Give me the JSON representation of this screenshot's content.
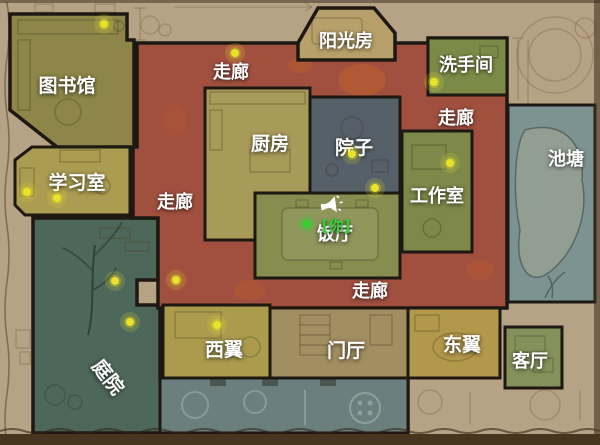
{
  "map": {
    "rooms": [
      {
        "id": "library",
        "label": "图书馆",
        "x": 67,
        "y": 92,
        "size": 19
      },
      {
        "id": "study",
        "label": "学习室",
        "x": 77,
        "y": 189,
        "size": 19
      },
      {
        "id": "sunroom",
        "label": "阳光房",
        "x": 346,
        "y": 47,
        "size": 18
      },
      {
        "id": "bathroom",
        "label": "洗手间",
        "x": 466,
        "y": 71,
        "size": 18
      },
      {
        "id": "corridor-top",
        "label": "走廊",
        "x": 231,
        "y": 78,
        "size": 18
      },
      {
        "id": "corridor-right",
        "label": "走廊",
        "x": 456,
        "y": 124,
        "size": 18
      },
      {
        "id": "corridor-left",
        "label": "走廊",
        "x": 175,
        "y": 208,
        "size": 18
      },
      {
        "id": "corridor-bottom",
        "label": "走廊",
        "x": 370,
        "y": 297,
        "size": 18
      },
      {
        "id": "kitchen",
        "label": "厨房",
        "x": 270,
        "y": 150,
        "size": 19
      },
      {
        "id": "courtyard",
        "label": "院子",
        "x": 354,
        "y": 154,
        "size": 19
      },
      {
        "id": "workshop",
        "label": "工作室",
        "x": 437,
        "y": 202,
        "size": 18
      },
      {
        "id": "dining",
        "label": "饭厅",
        "x": 335,
        "y": 240,
        "size": 18
      },
      {
        "id": "pond",
        "label": "池塘",
        "x": 566,
        "y": 165,
        "size": 18
      },
      {
        "id": "garden",
        "label": "庭院",
        "x": 103,
        "y": 381,
        "size": 19,
        "rotate": 52
      },
      {
        "id": "west-wing",
        "label": "西翼",
        "x": 224,
        "y": 356,
        "size": 19
      },
      {
        "id": "hall",
        "label": "门厅",
        "x": 346,
        "y": 357,
        "size": 19
      },
      {
        "id": "east-wing",
        "label": "东翼",
        "x": 462,
        "y": 351,
        "size": 19
      },
      {
        "id": "living-room",
        "label": "客厅",
        "x": 530,
        "y": 367,
        "size": 18
      }
    ],
    "collectibles": [
      {
        "x": 104,
        "y": 24
      },
      {
        "x": 235,
        "y": 53
      },
      {
        "x": 434,
        "y": 82
      },
      {
        "x": 27,
        "y": 192
      },
      {
        "x": 57,
        "y": 198
      },
      {
        "x": 352,
        "y": 154
      },
      {
        "x": 375,
        "y": 188
      },
      {
        "x": 450,
        "y": 163
      },
      {
        "x": 115,
        "y": 281
      },
      {
        "x": 130,
        "y": 322
      },
      {
        "x": 176,
        "y": 280
      },
      {
        "x": 217,
        "y": 325
      }
    ],
    "player": {
      "marker_label": "[你]",
      "x": 307,
      "y": 224,
      "label_x": 336,
      "label_y": 231
    },
    "colors": {
      "background": "#b6a385",
      "frame": "#483520",
      "corridor": "#a1503f",
      "library": "#8d8648",
      "study": "#aa9c50",
      "sunroom": "#b7a06a",
      "bathroom": "#7c8a48",
      "kitchen": "#a89a58",
      "courtyard": "#566068",
      "dining": "#868e4f",
      "workshop": "#7d8849",
      "pond": "#7d9392",
      "garden": "#4d675a",
      "terrace": "#6b7f7e",
      "west_wing": "#ab9b4d",
      "hall": "#a18e61",
      "east_wing": "#b2984a",
      "living_room": "#84915a",
      "collectible_dot": "#e8e22b",
      "player_green": "#35cf35",
      "label_text": "#ffffff"
    }
  }
}
